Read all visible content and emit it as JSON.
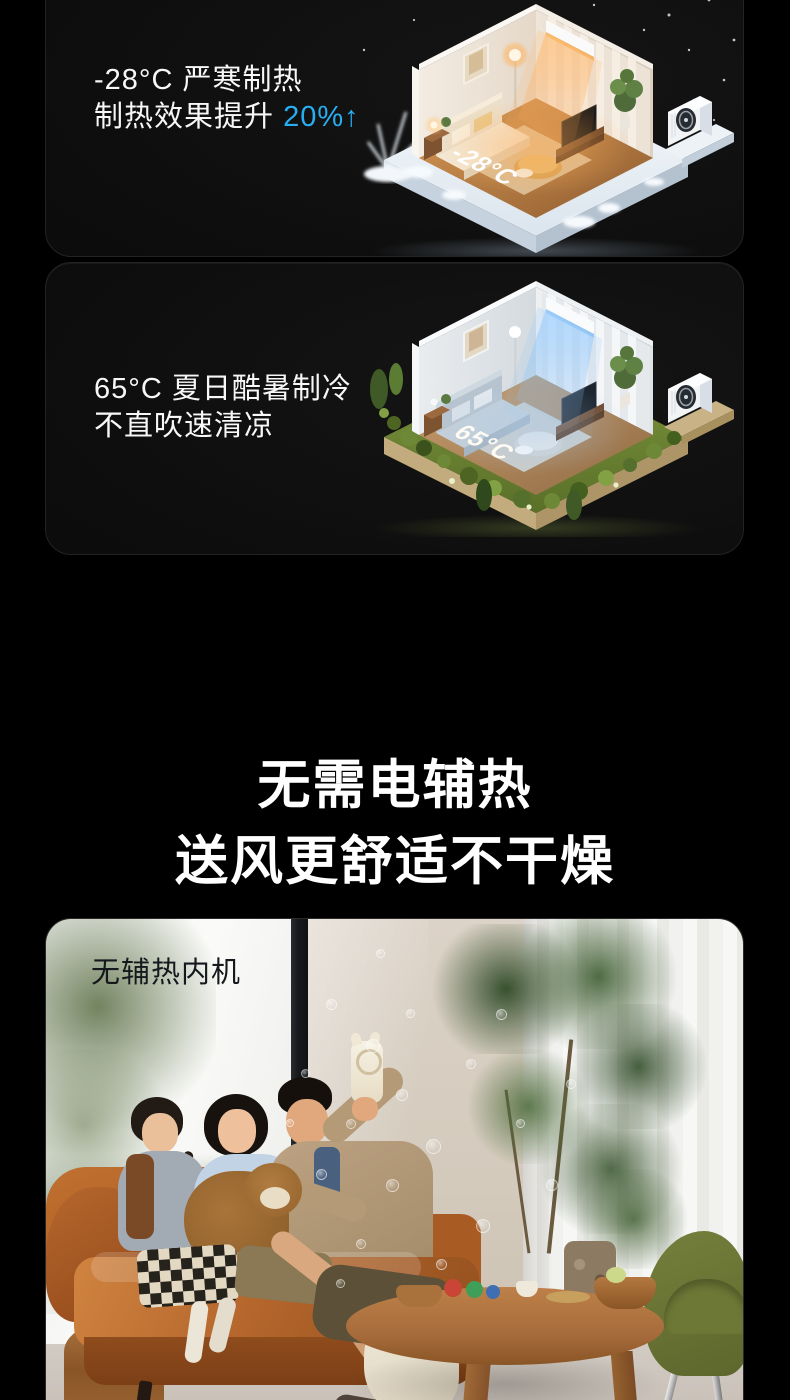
{
  "theme": {
    "page_bg": "#000000",
    "card_bg": "#0d0d0d",
    "card_border": "#232323",
    "text_primary": "#f7f7f7",
    "accent_blue": "#27aef2",
    "photo_label_color": "#15181c"
  },
  "cards": {
    "cold": {
      "line1": "-28°C 严寒制热",
      "line2_prefix": "制热效果提升 ",
      "line2_highlight": "20%↑",
      "scene_temp_label": "-28°C",
      "scene_icon": "isometric-winter-heating-room"
    },
    "hot": {
      "line1": "65°C 夏日酷暑制冷",
      "line2": "不直吹速清凉",
      "scene_temp_label": "65°C",
      "scene_icon": "isometric-summer-cooling-room"
    },
    "photo": {
      "label": "无辅热内机"
    }
  },
  "heading": {
    "line1": "无需电辅热",
    "line2": "送风更舒适不干燥"
  }
}
